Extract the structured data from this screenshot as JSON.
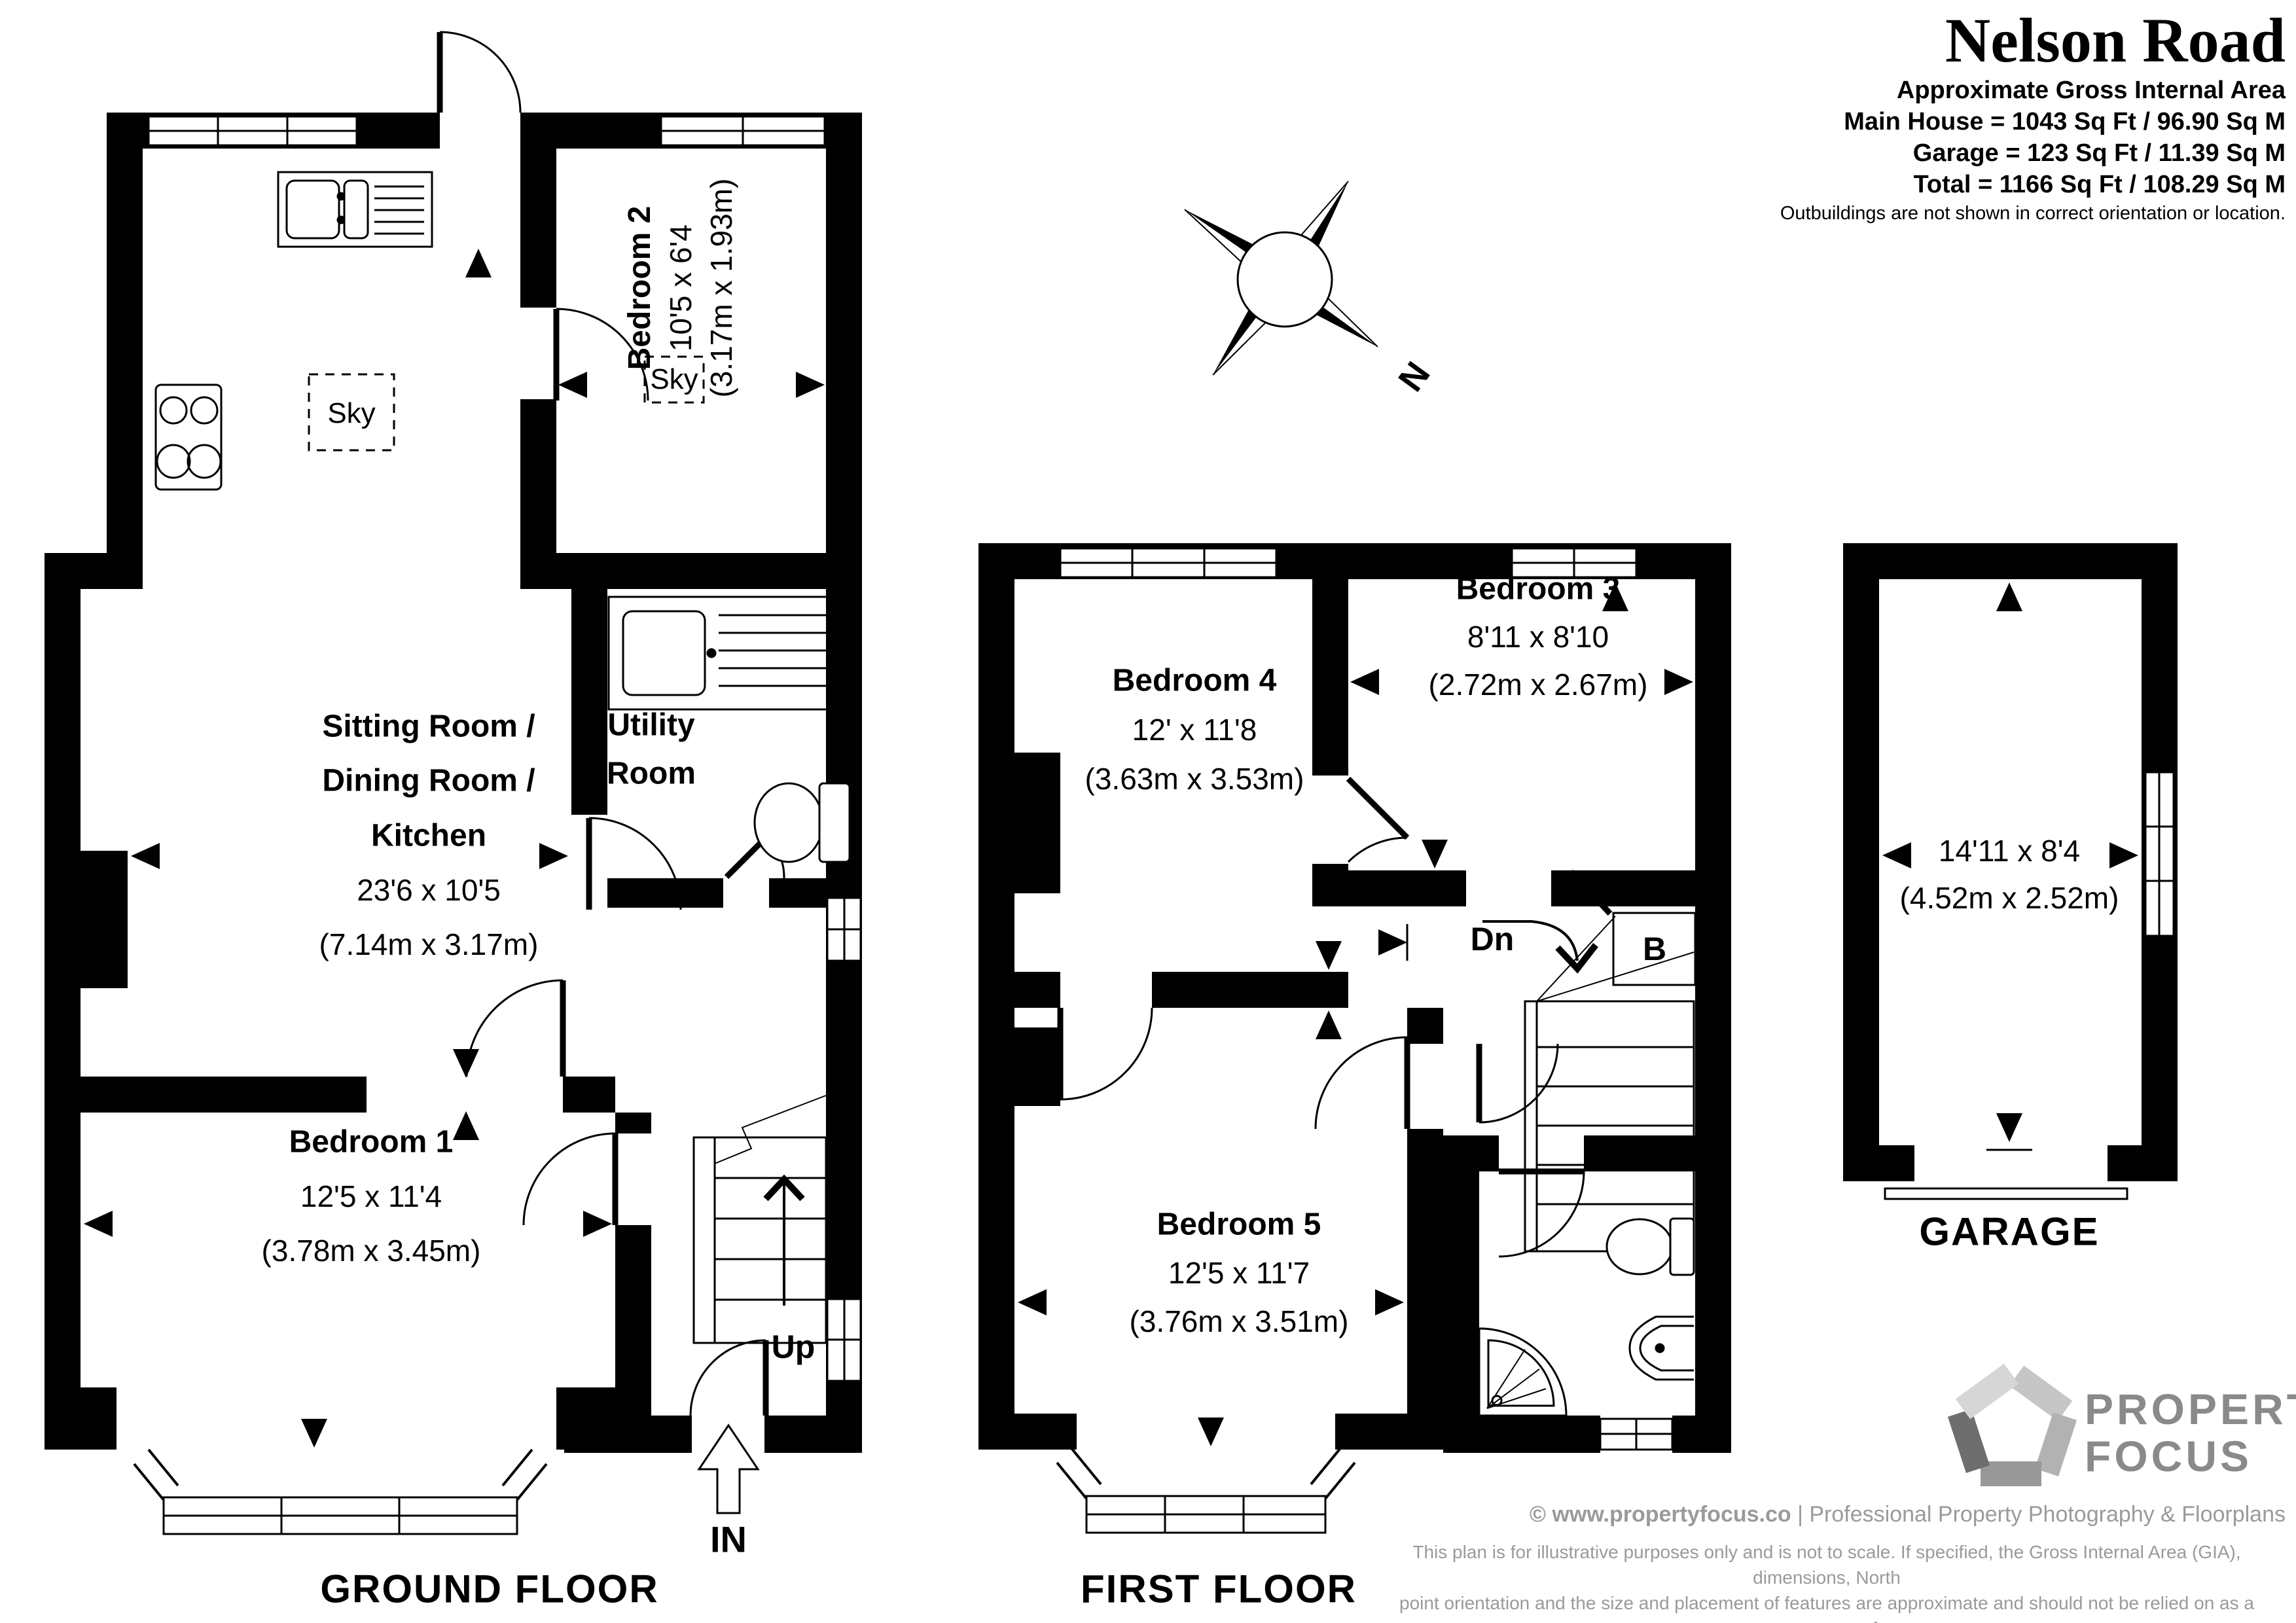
{
  "title_block": {
    "property_name": "Nelson Road",
    "area_heading": "Approximate Gross Internal Area",
    "area_lines": [
      "Main House = 1043 Sq Ft / 96.90 Sq M",
      "Garage = 123 Sq Ft / 11.39 Sq M",
      "Total = 1166 Sq Ft / 108.29 Sq M"
    ],
    "orientation_note": "Outbuildings are not shown in correct orientation or location."
  },
  "compass": {
    "north_label": "N"
  },
  "ground_floor": {
    "floor_label": "GROUND FLOOR",
    "sitting_dining_kitchen": {
      "name_lines": [
        "Sitting Room /",
        "Dining Room /",
        "Kitchen"
      ],
      "dims_imperial": "23'6 x 10'5",
      "dims_metric": "(7.14m x 3.17m)"
    },
    "utility_room": {
      "name_lines": [
        "Utility",
        "Room"
      ]
    },
    "bedroom_1": {
      "name": "Bedroom 1",
      "dims_imperial": "12'5 x 11'4",
      "dims_metric": "(3.78m x 3.45m)"
    },
    "bedroom_2": {
      "name": "Bedroom 2",
      "dims_imperial": "10'5 x 6'4",
      "dims_metric": "(3.17m x 1.93m)"
    },
    "skylight_kitchen_label": "Sky",
    "skylight_bedroom2_label": "Sky",
    "stairs_label": "Up",
    "entrance_label": "IN"
  },
  "first_floor": {
    "floor_label": "FIRST FLOOR",
    "bedroom_3": {
      "name": "Bedroom 3",
      "dims_imperial": "8'11 x 8'10",
      "dims_metric": "(2.72m x 2.67m)"
    },
    "bedroom_4": {
      "name": "Bedroom 4",
      "dims_imperial": "12' x 11'8",
      "dims_metric": "(3.63m x 3.53m)"
    },
    "bedroom_5": {
      "name": "Bedroom 5",
      "dims_imperial": "12'5 x 11'7",
      "dims_metric": "(3.76m x 3.51m)"
    },
    "stairs_label": "Dn",
    "boiler_label": "B"
  },
  "garage": {
    "floor_label": "GARAGE",
    "dims_imperial": "14'11 x 8'4",
    "dims_metric": "(4.52m x 2.52m)"
  },
  "footer": {
    "brand_lines": [
      "PROPERTY",
      "FOCUS"
    ],
    "copyright_strong": "© www.propertyfocus.co",
    "copyright_rest": " | Professional Property Photography & Floorplans",
    "disclaimer_lines": [
      "This plan is for illustrative purposes only and is not to scale. If specified, the Gross Internal Area (GIA), dimensions, North",
      "point orientation and the size and placement of features are approximate and should not be relied on as a statement of",
      "fact. No guarantee is given for the GIA and no responsibility is taken for any error, omission or misrepresentation."
    ]
  }
}
